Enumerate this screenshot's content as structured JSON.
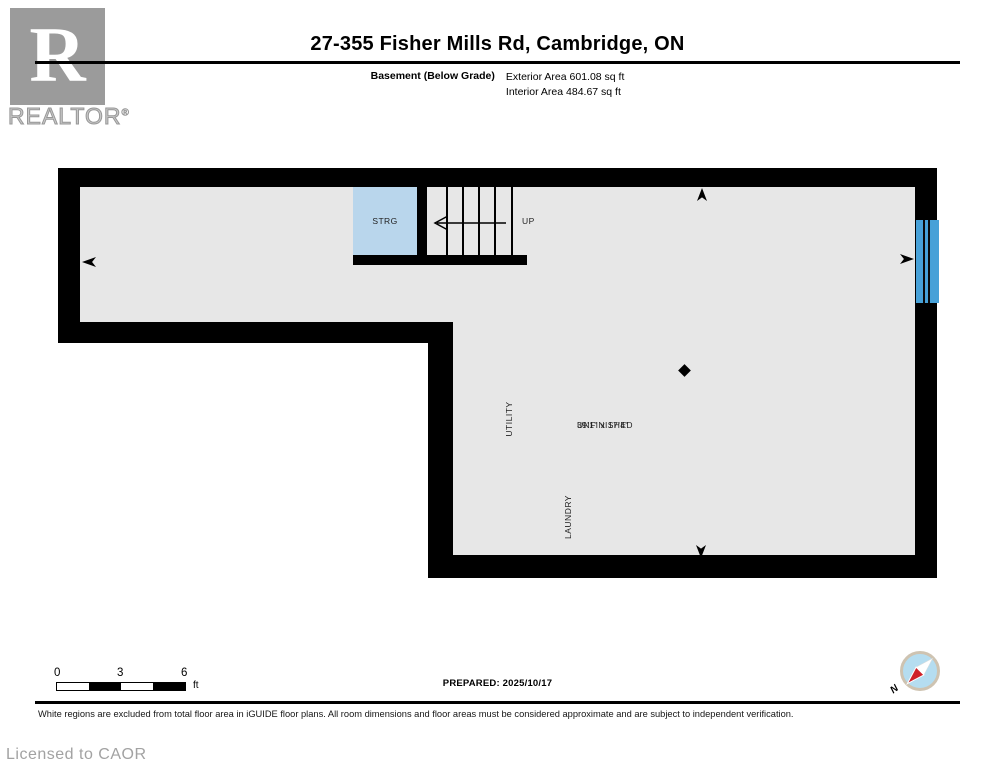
{
  "header": {
    "logo_letter": "R",
    "logo_brand": "REALTOR",
    "logo_registered": "®",
    "title": "27-355 Fisher Mills Rd, Cambridge, ON",
    "floor_label": "Basement (Below Grade)",
    "exterior_area": "Exterior Area 601.08 sq ft",
    "interior_area": "Interior Area 484.67 sq ft"
  },
  "plan": {
    "labels": {
      "storage": "STRG",
      "stairs_up": "UP",
      "utility": "UTILITY",
      "laundry": "LAUNDRY",
      "unfinished": "UNFINISHED",
      "unfinished_dims": "39'1\" x 17'4\""
    },
    "colors": {
      "floor_fill": "#e7e7e7",
      "wall": "#000000",
      "storage_fill": "#b9d6ec",
      "window_fill": "#47a1d8"
    }
  },
  "footer": {
    "scale_ticks": [
      "0",
      "3",
      "6"
    ],
    "scale_unit": "ft",
    "prepared": "PREPARED: 2025/10/17",
    "compass_north": "N",
    "disclaimer": "White regions are excluded from total floor area in iGUIDE floor plans. All room dimensions and floor areas must be considered approximate and are subject to independent verification.",
    "license": "Licensed to CAOR"
  }
}
